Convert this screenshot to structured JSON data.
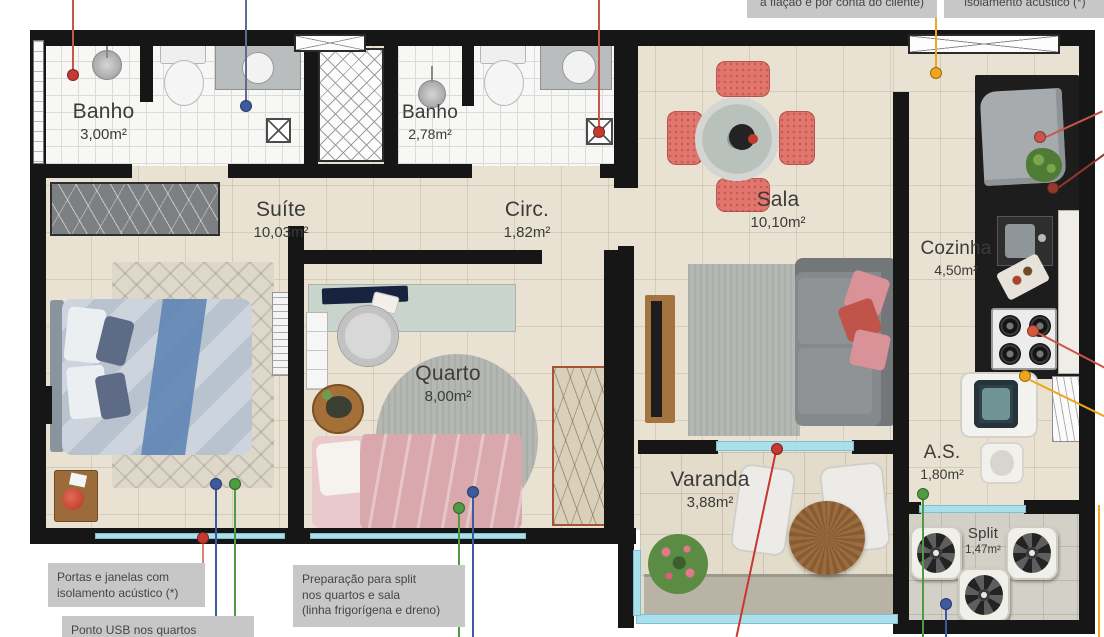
{
  "rooms": {
    "banho1": {
      "name": "Banho",
      "area": "3,00m²"
    },
    "banho2": {
      "name": "Banho",
      "area": "2,78m²"
    },
    "suite": {
      "name": "Suíte",
      "area": "10,03m²"
    },
    "circ": {
      "name": "Circ.",
      "area": "1,82m²"
    },
    "sala": {
      "name": "Sala",
      "area": "10,10m²"
    },
    "cozinha": {
      "name": "Cozinha",
      "area": "4,50m²"
    },
    "quarto": {
      "name": "Quarto",
      "area": "8,00m²"
    },
    "varanda": {
      "name": "Varanda",
      "area": "3,88m²"
    },
    "area_servico": {
      "name": "A.S.",
      "area": "1,80m²"
    },
    "split": {
      "name": "Split",
      "area": "1,47m²"
    }
  },
  "notes": {
    "top_wiring": "a fiação é por conta do cliente)",
    "top_acoustic": "isolamento acústico (*)",
    "doors_windows": "Portas e janelas com\nisolamento acústico (*)",
    "usb": "Ponto USB nos quartos",
    "split_prep": "Preparação para split\nnos quartos e sala\n(linha frigorígena e dreno)"
  },
  "callout_colors": {
    "red": "#c43a31",
    "dark_red": "#94382b",
    "salmon": "#dd8574",
    "blue": "#3d5a9e",
    "blue_gray": "#5d6c8a",
    "green": "#4f9b41",
    "yellow": "#efa51c",
    "glass_teal": "#a9e0ec"
  }
}
